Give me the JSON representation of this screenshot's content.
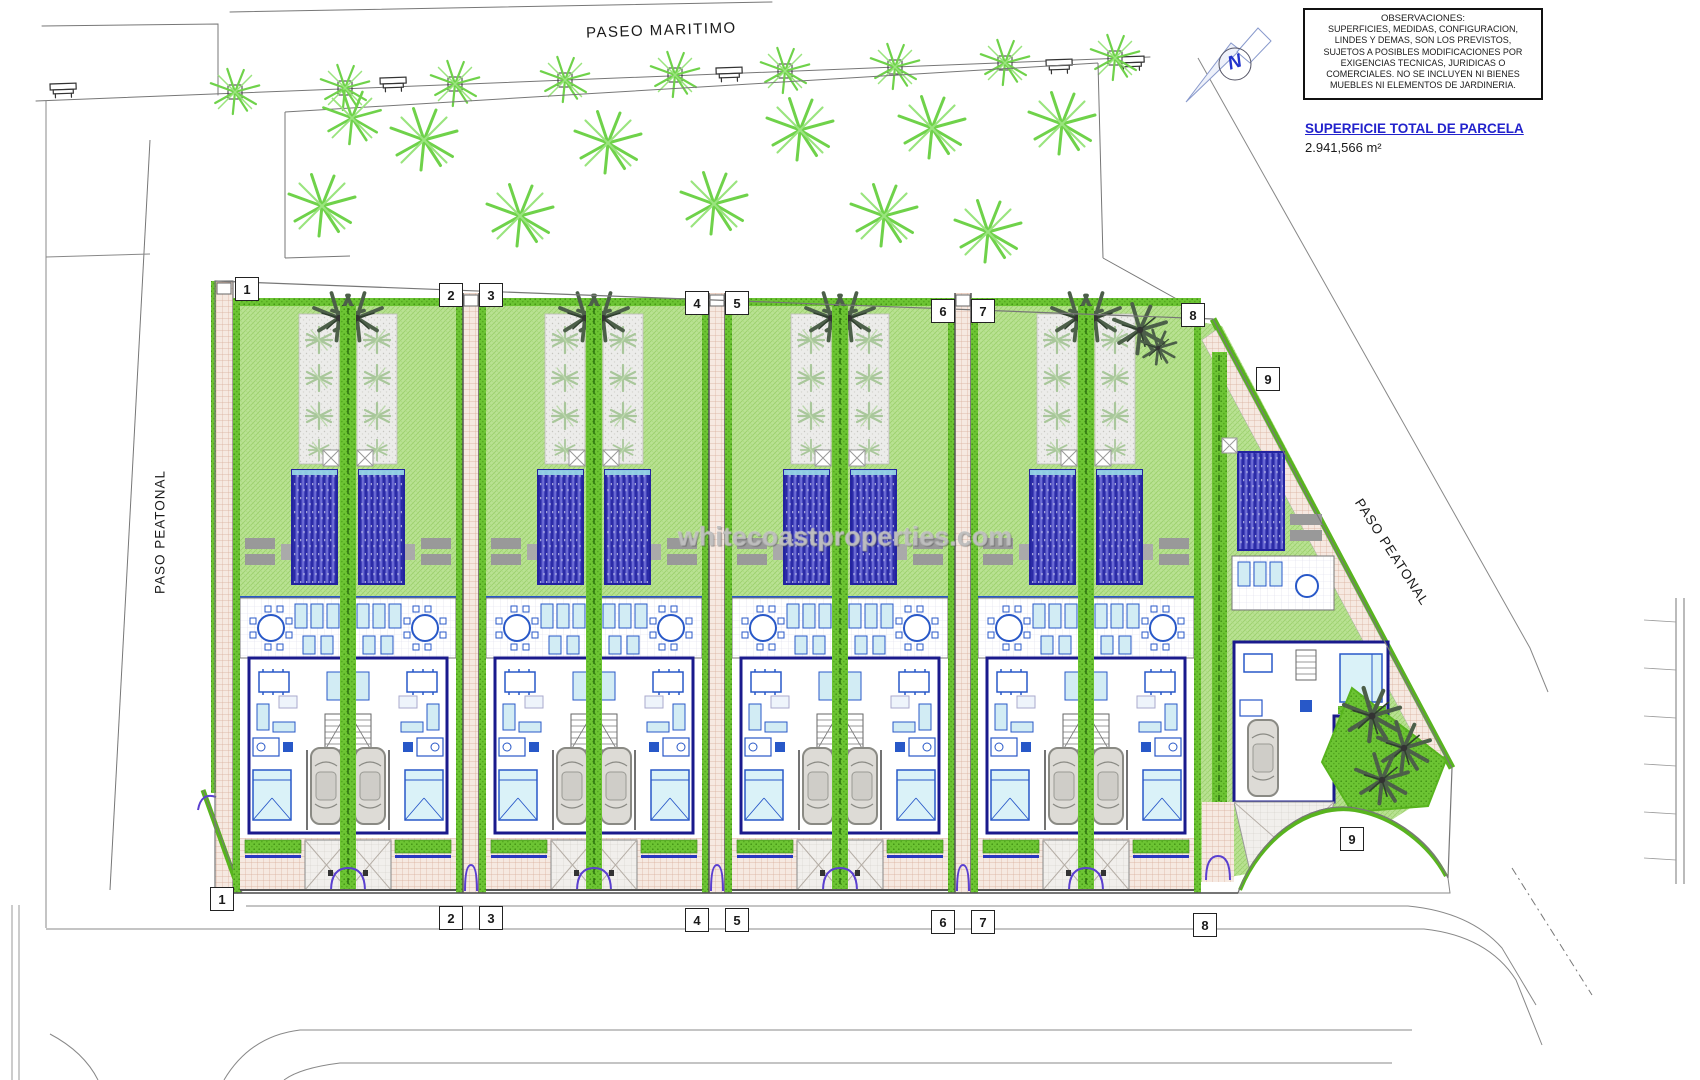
{
  "header": {
    "promenade_label": "PASEO MARITIMO",
    "north_letter": "N"
  },
  "notes_box": {
    "title": "OBSERVACIONES:",
    "body": "SUPERFICIES, MEDIDAS, CONFIGURACION,\nLINDES Y DEMAS, SON LOS PREVISTOS,\nSUJETOS A POSIBLES MODIFICACIONES POR\nEXIGENCIAS TECNICAS, JURIDICAS O\nCOMERCIALES. NO SE INCLUYEN NI BIENES\nMUEBLES NI ELEMENTOS DE JARDINERIA."
  },
  "area_summary": {
    "title": "SUPERFICIE TOTAL DE PARCELA",
    "value": "2.941,566 m²"
  },
  "street_labels": {
    "left": "PASO PEATONAL",
    "right": "PASO PEATONAL"
  },
  "watermark": "whitecoastproperties.com",
  "markers": [
    {
      "label": "1",
      "x": 247,
      "y": 289
    },
    {
      "label": "2",
      "x": 451,
      "y": 295
    },
    {
      "label": "3",
      "x": 491,
      "y": 295
    },
    {
      "label": "4",
      "x": 697,
      "y": 303
    },
    {
      "label": "5",
      "x": 737,
      "y": 303
    },
    {
      "label": "6",
      "x": 943,
      "y": 311
    },
    {
      "label": "7",
      "x": 983,
      "y": 311
    },
    {
      "label": "8",
      "x": 1193,
      "y": 315
    },
    {
      "label": "9",
      "x": 1268,
      "y": 379
    },
    {
      "label": "1",
      "x": 222,
      "y": 899
    },
    {
      "label": "2",
      "x": 451,
      "y": 918
    },
    {
      "label": "3",
      "x": 491,
      "y": 918
    },
    {
      "label": "4",
      "x": 697,
      "y": 920
    },
    {
      "label": "5",
      "x": 737,
      "y": 920
    },
    {
      "label": "6",
      "x": 943,
      "y": 922
    },
    {
      "label": "7",
      "x": 983,
      "y": 922
    },
    {
      "label": "8",
      "x": 1205,
      "y": 925
    },
    {
      "label": "9",
      "x": 1352,
      "y": 839
    }
  ],
  "colors": {
    "lawn_green": "#b9e293",
    "hedge_green": "#5cb820",
    "pool_blue": "#4343bb",
    "brick_path": "#f6e9e1",
    "villa_wall_blue": "#1a1a8c",
    "heading_blue": "#2222cc",
    "road_line_gray": "#888888"
  }
}
